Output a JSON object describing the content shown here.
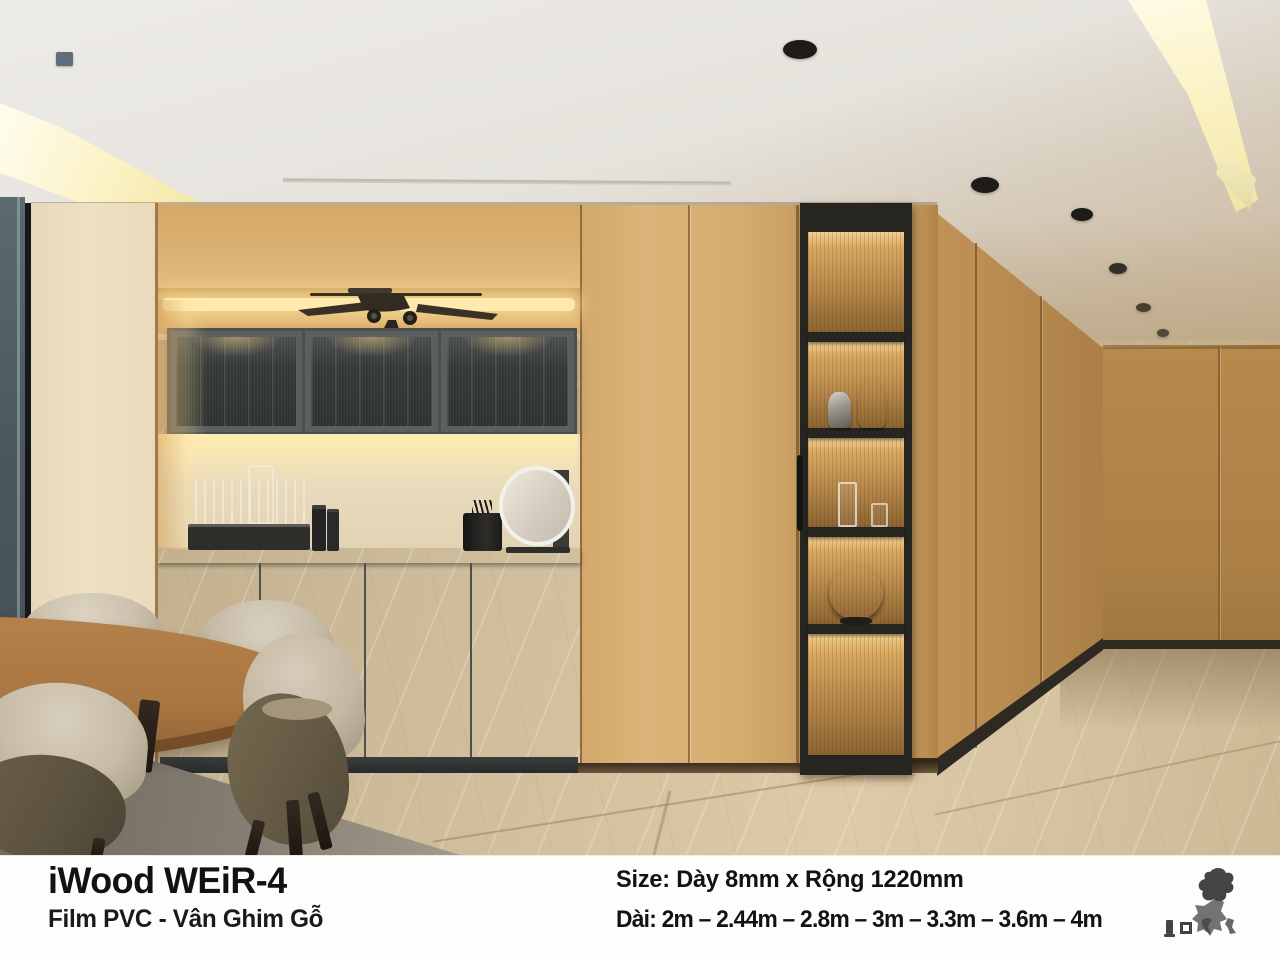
{
  "caption": {
    "title": "iWood WEiR-4",
    "subtitle": "Film PVC - Vân Ghim Gỗ",
    "size_line": "Size: Dày 8mm x Rộng 1220mm",
    "length_line": "Dài: 2m – 2.44m – 2.8m – 3m – 3.3m – 3.6m – 4m"
  },
  "scene": {
    "objects": [
      "wood-paneled-walls",
      "glass-upper-cabinets",
      "model-airplane",
      "display-shelf-column",
      "silver-figurines",
      "drinking-glasses",
      "globe",
      "round-mirror",
      "black-candle",
      "glass-tray",
      "gray-sideboard",
      "round-dining-table",
      "upholstered-chairs",
      "recessed-downlights",
      "cove-lights",
      "marble-tile-floor",
      "brand-stamp"
    ],
    "palette": {
      "ceiling": "#e9e7e2",
      "wood_light": "#d8af72",
      "wood_pale": "#ecdec0",
      "wood_mid": "#c09157",
      "wood_dark": "#a87e46",
      "cabinet_gray": "#676b6a",
      "countertop": "#3f4342",
      "shelf_frame": "#26251f",
      "led_glow": "#ffe9ae",
      "floor_marble": "#d5c2a2",
      "globe_teal": "#3b96ae",
      "window_slate": "#4a585c",
      "text_black": "#121212",
      "caption_bg": "#fdfdfb"
    }
  }
}
